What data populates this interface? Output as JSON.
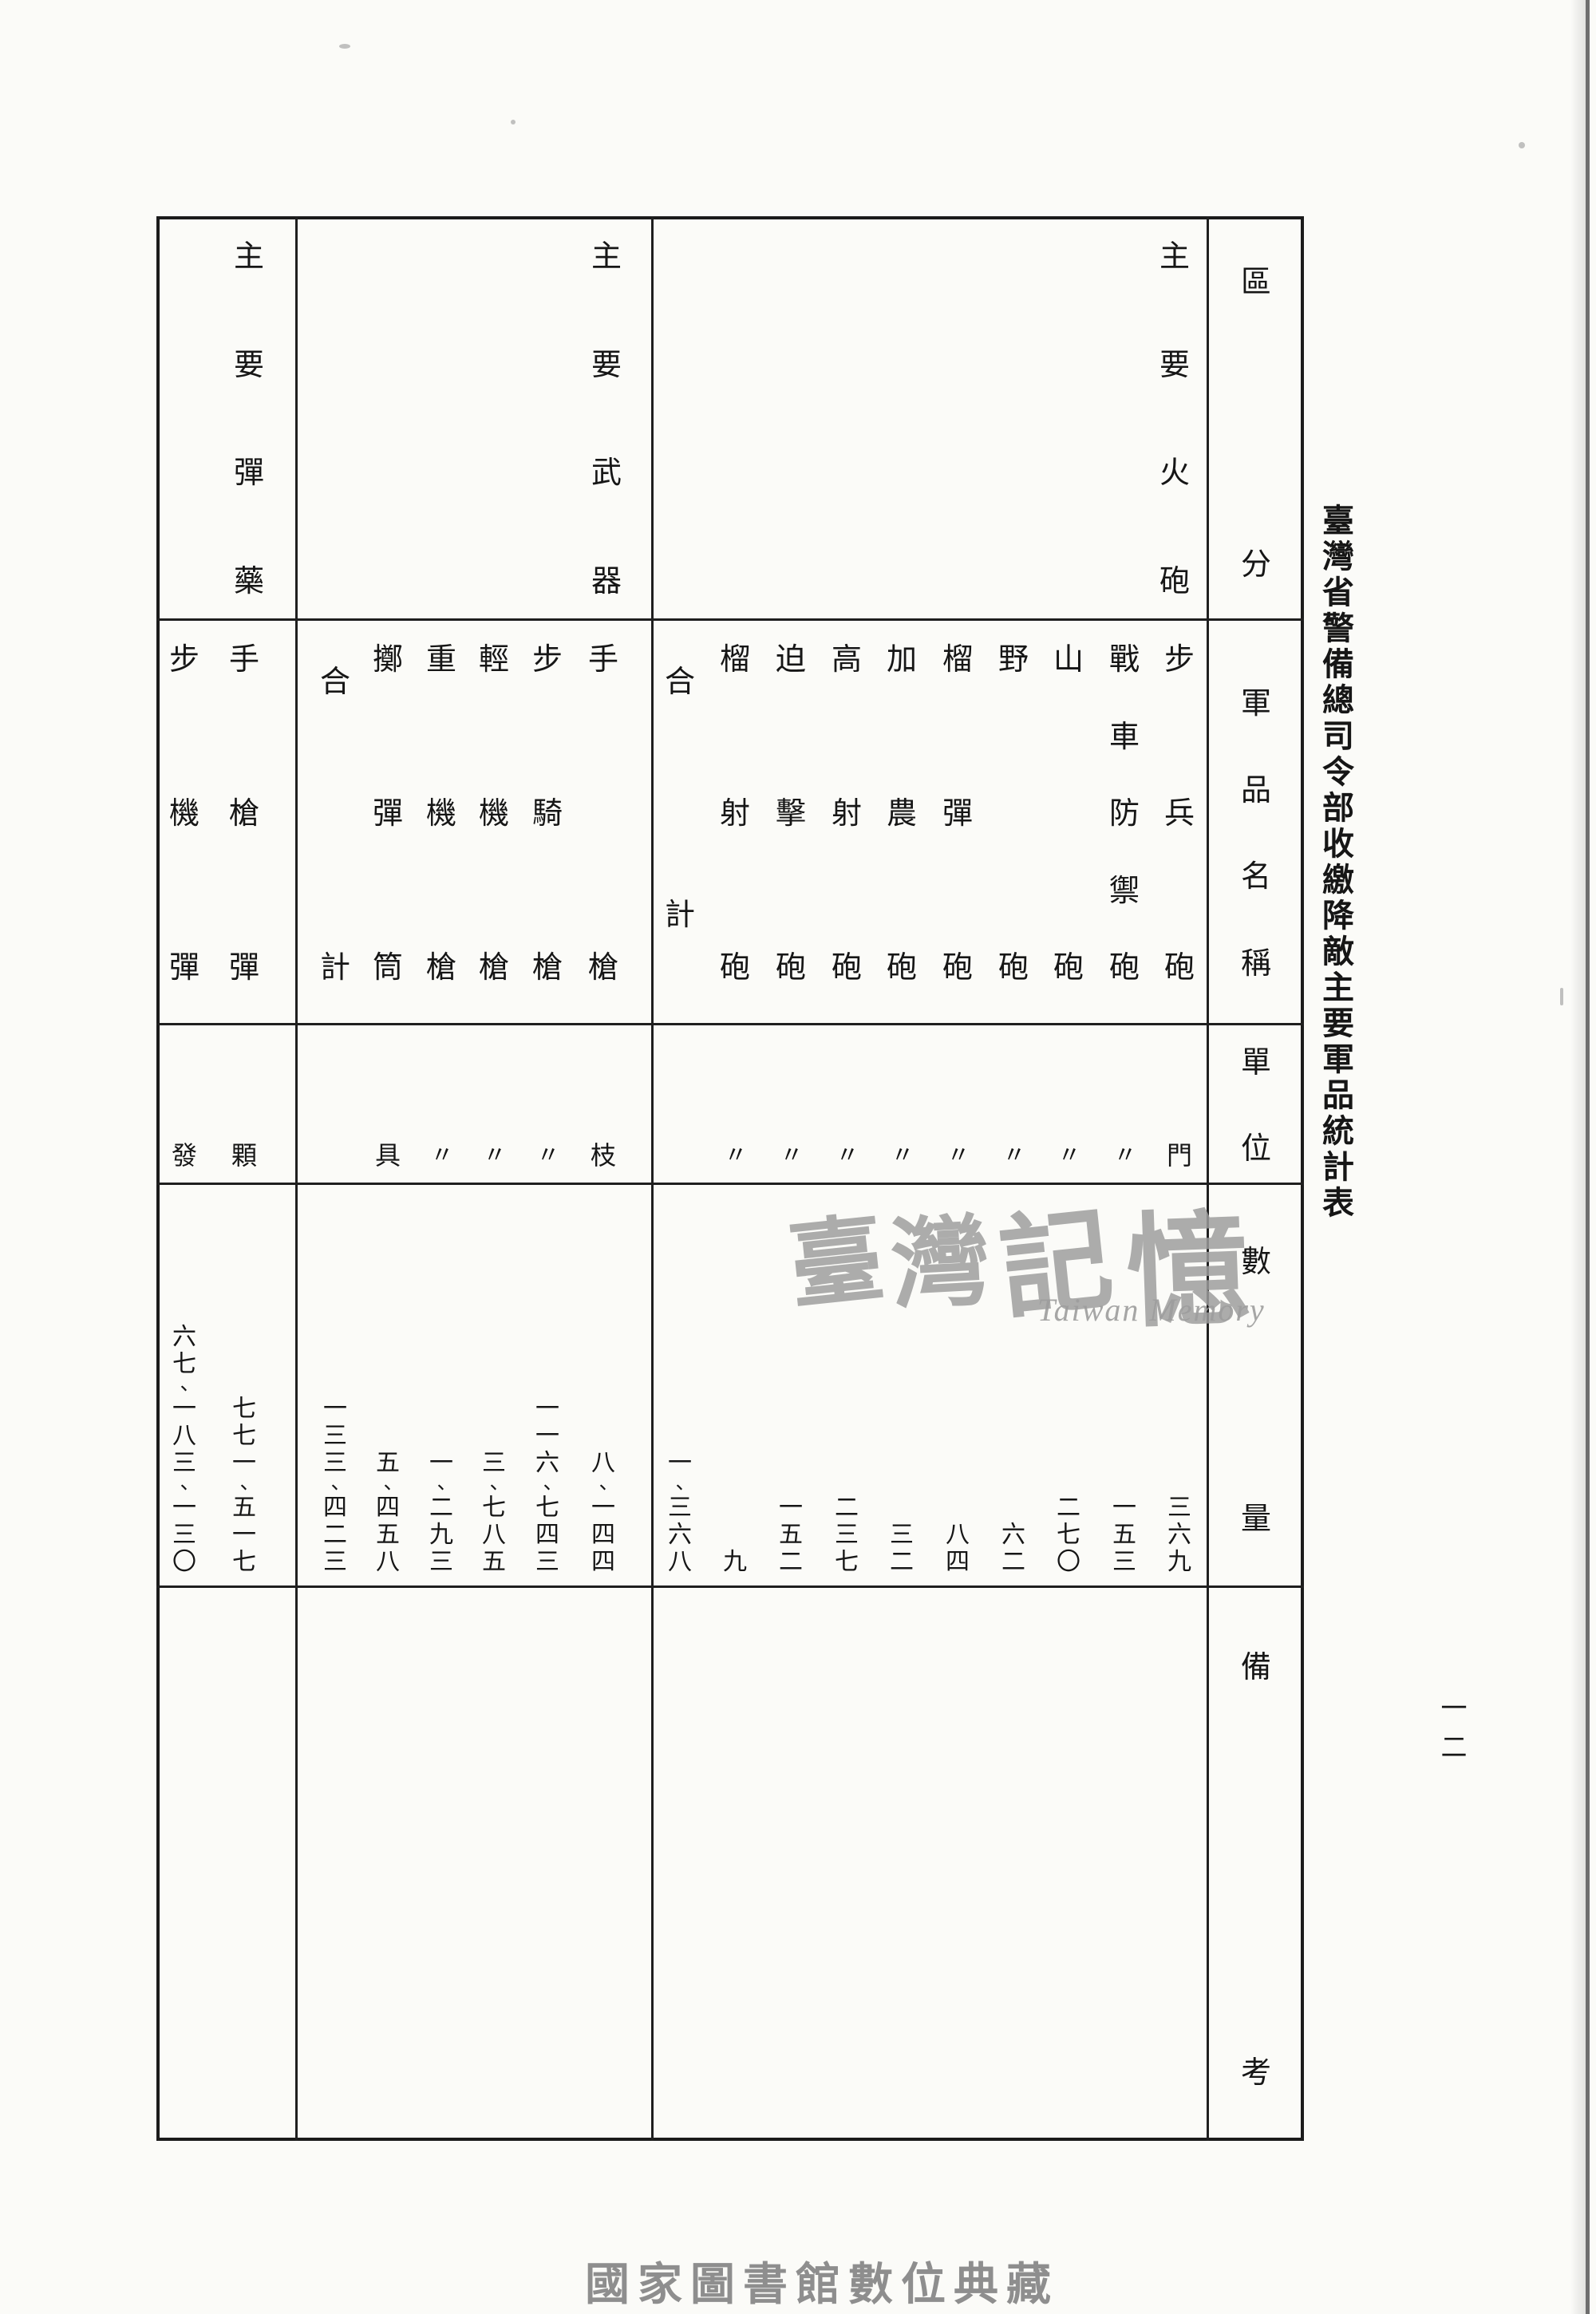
{
  "title": "臺灣省警備總司令部收繳降敵主要軍品統計表",
  "page": {
    "number": "一二",
    "footer": "國家圖書館數位典藏",
    "watermark": {
      "cjk": "臺灣記憶",
      "latin": "Taiwan Memory"
    }
  },
  "colors": {
    "ink": "#1b1b1b",
    "paper": "#fbfbf8",
    "watermark_gray": "#9d9d9d",
    "footer_gray": "#8e8e8e"
  },
  "table": {
    "headers": {
      "category": "區分",
      "item_name": "軍品名稱",
      "unit": "單位",
      "quantity": "數量",
      "remarks": "備考"
    },
    "groups": [
      {
        "category": "主要火砲",
        "items": [
          {
            "name": "步兵砲",
            "unit": "門",
            "qty": "三六九",
            "value": 369
          },
          {
            "name": "戰車防禦砲",
            "unit": "〃",
            "qty": "一五三",
            "value": 153
          },
          {
            "name": "山砲",
            "unit": "〃",
            "qty": "二七〇",
            "value": 270
          },
          {
            "name": "野砲",
            "unit": "〃",
            "qty": "六二",
            "value": 62
          },
          {
            "name": "榴彈砲",
            "unit": "〃",
            "qty": "八四",
            "value": 84
          },
          {
            "name": "加農砲",
            "unit": "〃",
            "qty": "三二",
            "value": 32
          },
          {
            "name": "高射砲",
            "unit": "〃",
            "qty": "二三七",
            "value": 237
          },
          {
            "name": "迫擊砲",
            "unit": "〃",
            "qty": "一五二",
            "value": 152
          },
          {
            "name": "榴射砲",
            "unit": "〃",
            "qty": "九",
            "value": 9
          },
          {
            "name": "合計",
            "unit": "",
            "qty": "一、三六八",
            "value": 1368,
            "is_total": true
          }
        ]
      },
      {
        "category": "主要武器",
        "items": [
          {
            "name": "手槍",
            "unit": "枝",
            "qty": "八、一四四",
            "value": 8144
          },
          {
            "name": "步騎槍",
            "unit": "〃",
            "qty": "一一六、七四三",
            "value": 116743
          },
          {
            "name": "輕機槍",
            "unit": "〃",
            "qty": "三、七八五",
            "value": 3785
          },
          {
            "name": "重機槍",
            "unit": "〃",
            "qty": "一、二九三",
            "value": 1293
          },
          {
            "name": "擲彈筒",
            "unit": "具",
            "qty": "五、四五八",
            "value": 5458
          },
          {
            "name": "合計",
            "unit": "",
            "qty": "一三三、四二三",
            "value": 133423,
            "is_total": true
          }
        ]
      },
      {
        "category": "主要彈藥",
        "items": [
          {
            "name": "手槍彈",
            "unit": "顆",
            "qty": "七七一、五一七",
            "value": 771517
          },
          {
            "name": "步機彈",
            "unit": "發",
            "qty": "六七、一八三、一三〇",
            "value": 67183130
          }
        ]
      }
    ]
  }
}
